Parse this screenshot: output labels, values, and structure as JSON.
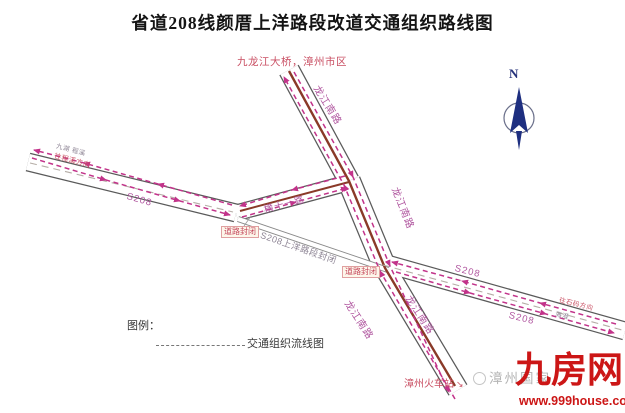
{
  "title": "省道208线颜厝上洋路段改道交通组织路线图",
  "compass": {
    "n": "N"
  },
  "map": {
    "north_destination": "九龙江大桥，漳州市区",
    "station": "漳州火车站",
    "station_arrow": "↘",
    "roads": {
      "longjiang": "龙江南路",
      "s208": "S208",
      "heng11": "横十一路"
    },
    "closure": {
      "section": "S208上洋路段封闭",
      "road_closed": "道路封闭"
    },
    "edge_labels": {
      "west_top": "九湖 程溪",
      "west_bottom": "往程溪方向",
      "east_top": "往石码方向",
      "east_bottom": "海澄"
    }
  },
  "legend": {
    "title": "图例：",
    "flow_label": "交通组织流线图"
  },
  "watermark": {
    "gray": "漳州国家",
    "brand": "九房网",
    "url": "www.999house.com"
  },
  "colors": {
    "flow_pink": "#c2338a",
    "median_brown": "#8a3a28",
    "road_name_pink": "#b0569f",
    "closed_text_gray": "#8d8494",
    "brand_red": "#cc1616",
    "compass_navy": "#1e2f80",
    "title_black": "#141414"
  }
}
